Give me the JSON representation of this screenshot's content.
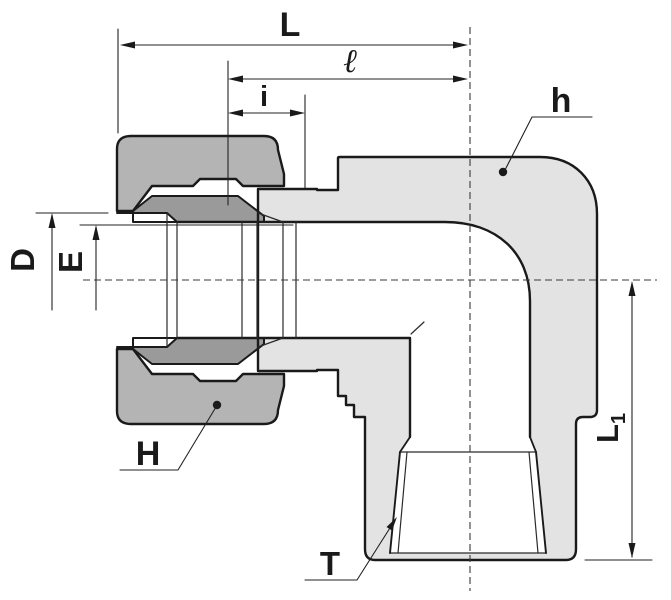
{
  "title": "90-degree elbow tube fitting, female threaded port - sectional dimension drawing",
  "labels": {
    "L": "L",
    "ell": "ℓ",
    "i": "i",
    "D": "D",
    "E": "E",
    "H": "H",
    "h": "h",
    "T": "T",
    "L1_main": "L",
    "L1_sub": "1"
  },
  "colors": {
    "background": "#ffffff",
    "line": "#1a1a1a",
    "thin_line": "#2a2a2a",
    "body_fill": "#e3e3e3",
    "nut_fill": "#b4b4b4",
    "ferrule_fill": "#9a9a9a"
  }
}
